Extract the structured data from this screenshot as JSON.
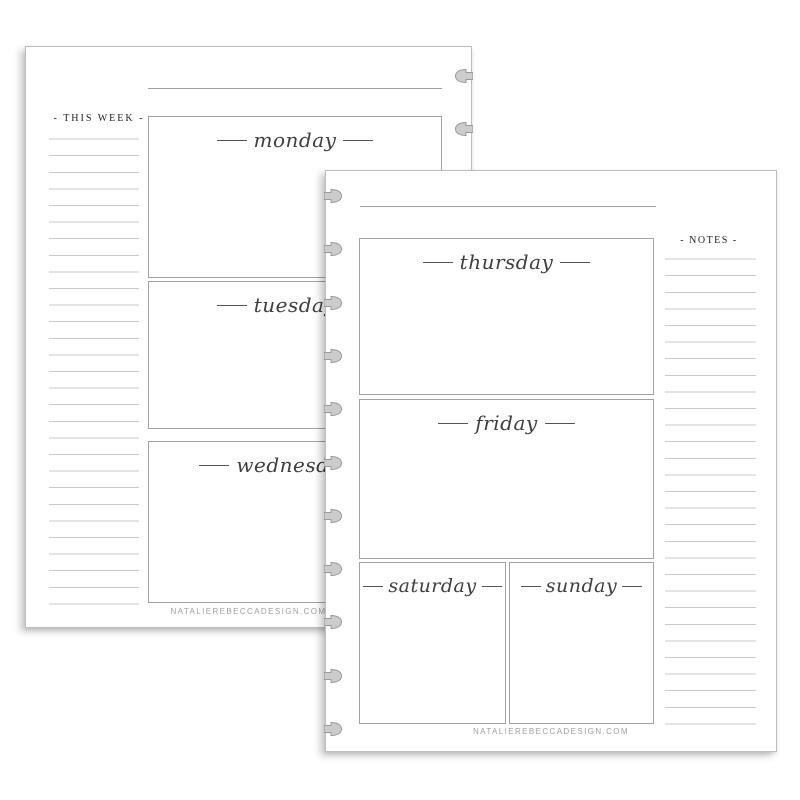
{
  "back_page": {
    "sidebar_label": "- THIS WEEK -",
    "days": [
      {
        "name": "monday"
      },
      {
        "name": "tuesday"
      },
      {
        "name": "wednesday"
      }
    ],
    "footer": "NATALIEREBECCADESIGN.COM"
  },
  "front_page": {
    "sidebar_label": "- NOTES -",
    "days": [
      {
        "name": "thursday"
      },
      {
        "name": "friday"
      },
      {
        "name": "saturday"
      },
      {
        "name": "sunday"
      }
    ],
    "footer": "NATALIEREBECCADESIGN.COM"
  },
  "colors": {
    "page_background": "#ffffff",
    "page_border": "#bdbdbd",
    "box_border": "#a3a3a3",
    "ruled_line": "#c9c9c9",
    "script_text": "#3f3f3f",
    "label_text": "#1e1e1e",
    "footer_text": "#a0a0a0",
    "punch_fill": "#cccccc",
    "punch_stroke": "#999999"
  }
}
